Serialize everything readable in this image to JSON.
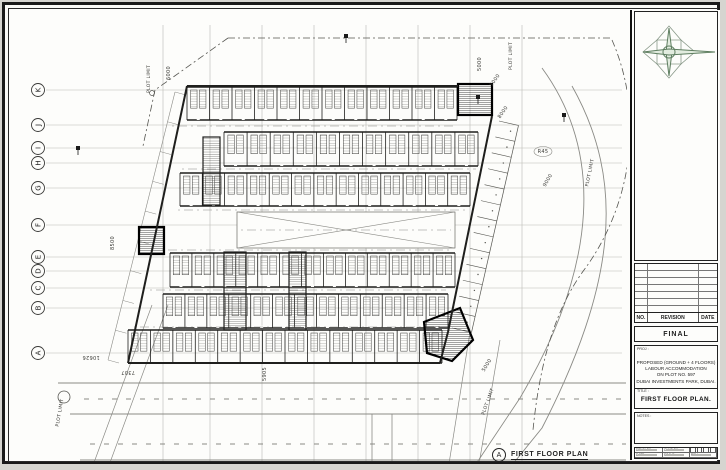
{
  "titleblock": {
    "status": "FINAL",
    "revision": {
      "headers": [
        "NO.",
        "REVISION",
        "DATE"
      ],
      "blank_rows": 7
    },
    "project_label": "PROJ :",
    "project_lines": [
      "PROPOSED (GROUND + 4 FLOORS)",
      "LABOUR ACCOMMODATION",
      "ON PLOT NO. 597",
      "DUBAI INVESTMENTS PARK, DUBAI."
    ],
    "title_label": "TITLE :",
    "drawing_title": "FIRST FLOOR PLAN.",
    "notes_label": "NOTES :",
    "fields": {
      "drawn": "DRWN BY :",
      "checked": "CHKD BY :",
      "date": "DATE :",
      "scale": "SCALE :",
      "rev": "REV :"
    },
    "compass_icon": "north-compass-rose",
    "compass_colors": {
      "fill": "#e2ecdf",
      "stroke": "#5d7d5f",
      "alt": "#8a9a8a"
    }
  },
  "view_label": {
    "bubble": "A",
    "title": "FIRST FLOOR PLAN"
  },
  "plan": {
    "grid_rows": [
      [
        "K",
        90
      ],
      [
        "J",
        125
      ],
      [
        "I",
        148
      ],
      [
        "H",
        163
      ],
      [
        "G",
        188
      ],
      [
        "F",
        225
      ],
      [
        "E",
        257
      ],
      [
        "D",
        271
      ],
      [
        "C",
        288
      ],
      [
        "B",
        308
      ],
      [
        "A",
        353
      ]
    ],
    "grid_cols": [
      163,
      210,
      262,
      314,
      366,
      418,
      470,
      522
    ],
    "walls": [
      [
        187,
        86,
        458,
        86
      ],
      [
        492,
        116,
        448,
        332
      ],
      [
        128,
        363,
        440,
        363
      ],
      [
        187,
        86,
        128,
        363
      ],
      [
        448,
        332,
        440,
        363
      ]
    ],
    "rows": [
      {
        "y": 87,
        "h": 33,
        "x0": 187,
        "x1": 457,
        "n": 12
      },
      {
        "y": 132,
        "h": 34,
        "x0": 224,
        "x1": 478,
        "n": 11
      },
      {
        "y": 173,
        "h": 33,
        "x0": 180,
        "x1": 470,
        "n": 13
      },
      {
        "y": 253,
        "h": 34,
        "x0": 170,
        "x1": 455,
        "n": 13
      },
      {
        "y": 294,
        "h": 34,
        "x0": 163,
        "x1": 448,
        "n": 13
      },
      {
        "y": 330,
        "h": 33,
        "x0": 128,
        "x1": 442,
        "n": 14
      }
    ],
    "corridors": [
      [
        172,
        126,
        455,
        126
      ],
      [
        182,
        169,
        476,
        169
      ],
      [
        178,
        210,
        468,
        210
      ],
      [
        162,
        250,
        453,
        250
      ],
      [
        150,
        290,
        446,
        290
      ],
      [
        134,
        327,
        440,
        327
      ]
    ],
    "hall": [
      237,
      212,
      218,
      36
    ],
    "cores": [
      [
        203,
        137,
        17,
        68
      ],
      [
        224,
        252,
        22,
        78
      ],
      [
        289,
        252,
        17,
        78
      ]
    ],
    "stairs": [
      [
        458,
        84,
        34,
        31
      ],
      [
        139,
        227,
        25,
        27
      ]
    ],
    "stair_poly": [
      [
        424,
        322
      ],
      [
        460,
        308
      ],
      [
        473,
        340
      ],
      [
        452,
        361
      ],
      [
        427,
        353
      ]
    ],
    "parking_right": {
      "p1": [
        499,
        121
      ],
      "p2": [
        452,
        328
      ],
      "n": 13,
      "out": [
        19.5,
        4.4
      ]
    },
    "left_edge_offset": [
      [
        175,
        92
      ],
      [
        108,
        360
      ]
    ],
    "plot_dash": [
      [
        228,
        38,
        612,
        38
      ],
      [
        228,
        38,
        155,
        90
      ],
      [
        155,
        90,
        143,
        146
      ]
    ],
    "plot_curve": "M612,40 C646,118 630,208 584,270 C556,308 540,360 533,430",
    "road_curves": [
      "M542,68 C602,150 600,262 520,398 L472,470",
      "M572,86 C626,182 616,284 542,428 L508,470"
    ],
    "roads_solid": [
      [
        58,
        383,
        626,
        383
      ],
      [
        70,
        414,
        626,
        414
      ],
      [
        80,
        460,
        626,
        460
      ]
    ],
    "roads_dashed": [
      [
        84,
        399,
        626,
        399
      ],
      [
        90,
        444,
        626,
        444
      ]
    ],
    "road_verticals": [
      [
        372,
        414,
        372,
        470
      ],
      [
        392,
        414,
        392,
        470
      ]
    ],
    "left_diags": [
      [
        168,
        305,
        108,
        468
      ],
      [
        152,
        305,
        92,
        468
      ]
    ],
    "right_diags": [
      [
        470,
        332,
        448,
        470
      ],
      [
        500,
        340,
        478,
        470
      ]
    ],
    "labels": [
      [
        "PLOT LIMIT",
        150,
        79,
        -90
      ],
      [
        "6000",
        170,
        73,
        -90
      ],
      [
        "PLOT LIMIT",
        512,
        56,
        -90
      ],
      [
        "5000",
        481,
        64,
        -90
      ],
      [
        "5000",
        496,
        81,
        -55
      ],
      [
        "8000",
        504,
        113,
        -55
      ],
      [
        "R45",
        543,
        153,
        0
      ],
      [
        "9000",
        549,
        181,
        -60
      ],
      [
        "PLOT LIMIT",
        591,
        173,
        -78
      ],
      [
        "8500",
        114,
        243,
        -90
      ],
      [
        "10626",
        91,
        356,
        180
      ],
      [
        "7307",
        128,
        371,
        180
      ],
      [
        "5905",
        266,
        374,
        -90
      ],
      [
        "5000",
        488,
        366,
        -58
      ],
      [
        "PLOT LIMIT",
        61,
        413,
        -80
      ],
      [
        "PLOT LIMIT",
        489,
        402,
        -70
      ]
    ],
    "markers": [
      [
        346,
        36
      ],
      [
        478,
        97
      ],
      [
        78,
        148
      ],
      [
        564,
        115
      ]
    ],
    "manhole": [
      64,
      397
    ],
    "corner_circle": [
      152,
      93
    ],
    "colors": {
      "faint": "#b9b9b4",
      "line": "#555550",
      "wall": "#1f1f1d",
      "road": "#8a8a85",
      "text": "#3a3a36"
    }
  }
}
